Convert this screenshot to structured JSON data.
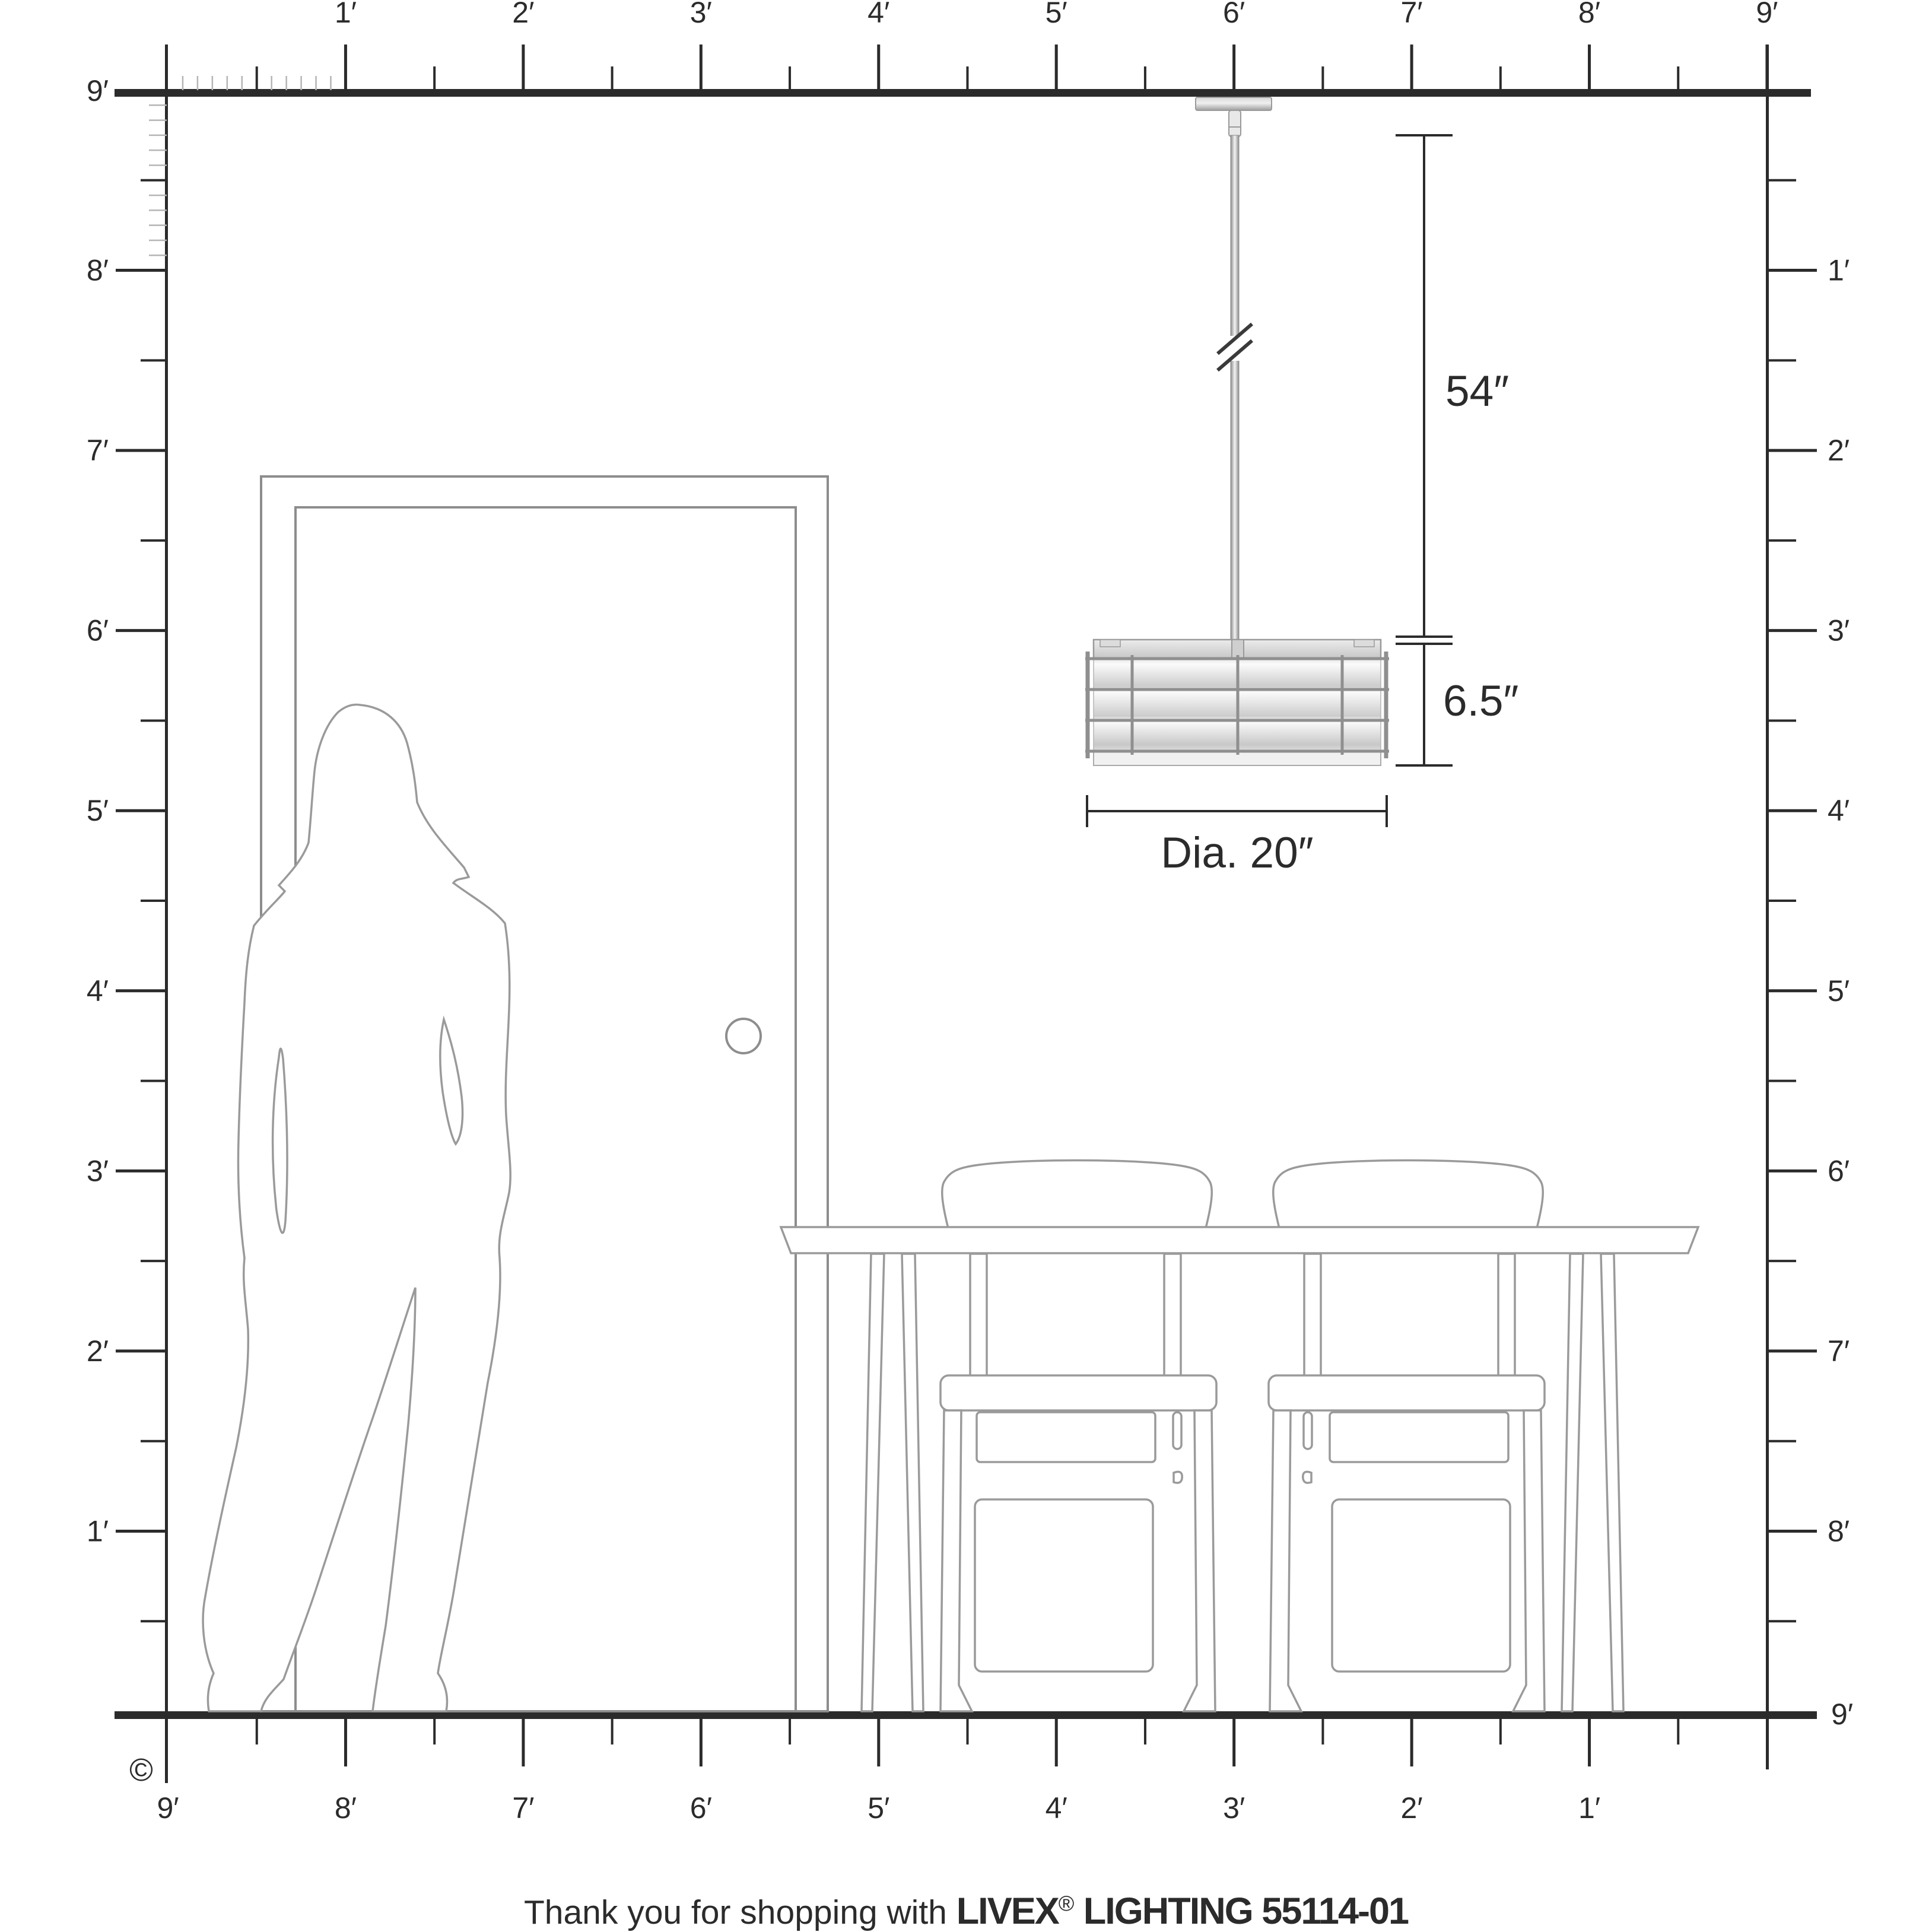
{
  "colors": {
    "ink": "#2b2b2b",
    "light_tick": "#b5b5b5",
    "furniture_outline": "#9a9a9a",
    "door_outline": "#8d8d8d",
    "metal": "#8f8f8f"
  },
  "rulers": {
    "top": {
      "labels": [
        "1′",
        "2′",
        "3′",
        "4′",
        "5′",
        "6′",
        "7′",
        "8′",
        "9′"
      ]
    },
    "bottom": {
      "labels": [
        "9′",
        "8′",
        "7′",
        "6′",
        "5′",
        "4′",
        "3′",
        "2′",
        "1′"
      ]
    },
    "left": {
      "corner_top": "9′",
      "labels": [
        "8′",
        "7′",
        "6′",
        "5′",
        "4′",
        "3′",
        "2′",
        "1′"
      ]
    },
    "right": {
      "labels": [
        "1′",
        "2′",
        "3′",
        "4′",
        "5′",
        "6′",
        "7′",
        "8′"
      ],
      "corner_bottom": "9′"
    }
  },
  "dimensions": {
    "drop": "54″",
    "fixture_height": "6.5″",
    "diameter": "Dia. 20″"
  },
  "copyright": "©",
  "footer": {
    "prefix": "Thank you for shopping with ",
    "brand": "LIVEX",
    "registered": "®",
    "suffix": " LIGHTING 55114-01"
  }
}
